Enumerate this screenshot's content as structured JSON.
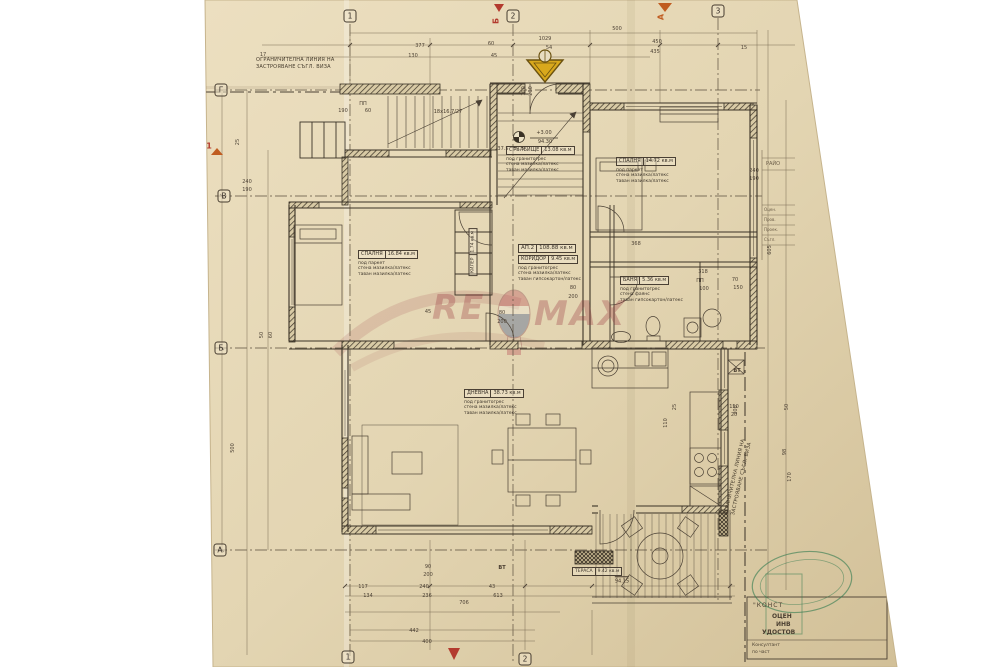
{
  "notes": {
    "boundary_top_l1": "ОГРАНИЧИТЕЛНА ЛИНИЯ НА",
    "boundary_top_l2": "ЗАСТРОЯВАНЕ СЪГЛ. ВИЗА",
    "boundary_right_l1": "ОГРАНИЧИТЕЛНА ЛИНИЯ НА",
    "boundary_right_l2": "ЗАСТРОЯВАНЕ СЪГЛ. ВИЗА",
    "stair_formula": "18x16.7/27",
    "elev_rel": "+3.00",
    "elev_abs": "94.30",
    "terrace_elev": "94.15",
    "vt1": "ВТ",
    "vt2": "ВТ"
  },
  "apartment": {
    "name": "АП.2",
    "area": "108.88 кв.м"
  },
  "rooms": [
    {
      "name": "СТЪЛБИЩЕ",
      "area": "13.08 кв.м",
      "f1": "под гранитогрес",
      "f2": "стена мазилка/латекс",
      "f3": "таван мазилка/латекс"
    },
    {
      "name": "СПАЛНЯ",
      "area": "14.72 кв.м",
      "f1": "под паркет",
      "f2": "стена мазилка/латекс",
      "f3": "таван мазилка/латекс"
    },
    {
      "name": "СПАЛНЯ",
      "area": "16.84 кв.м",
      "f1": "под паркет",
      "f2": "стена мазилка/латекс",
      "f3": "таван мазилка/латекс"
    },
    {
      "name": "КОРИДОР",
      "area": "9.45 кв.м",
      "f1": "под гранитогрес",
      "f2": "стена мазилка/латекс",
      "f3": "таван гипсокартон/латекс"
    },
    {
      "name": "БАНЯ",
      "area": "5.36 кв.м",
      "f1": "под гранитогрес",
      "f2": "стена фаянс",
      "f3": "таван гипсокартон/латекс"
    },
    {
      "name": "ДНЕВНА",
      "area": "38.73 кв.м",
      "f1": "под гранитогрес",
      "f2": "стена мазилка/латекс",
      "f3": "таван мазилка/латекс"
    },
    {
      "name": "КИЛЕР",
      "area": "1.74 кв.м"
    },
    {
      "name": "ТЕРАСА",
      "area": "9.42 кв.м"
    }
  ],
  "axis": {
    "top": [
      {
        "t": "1",
        "x": 350,
        "y": 16
      },
      {
        "t": "2",
        "x": 513,
        "y": 16
      },
      {
        "t": "3",
        "x": 718,
        "y": 11
      }
    ],
    "bottom": [
      {
        "t": "1",
        "x": 348,
        "y": 657
      },
      {
        "t": "2",
        "x": 525,
        "y": 659
      }
    ],
    "left": [
      {
        "t": "Г",
        "x": 221,
        "y": 90
      },
      {
        "t": "В",
        "x": 224,
        "y": 196
      },
      {
        "t": "Б",
        "x": 221,
        "y": 348
      },
      {
        "t": "А",
        "x": 220,
        "y": 550
      }
    ]
  },
  "red_marks": [
    {
      "t": "Б",
      "x": 496,
      "y": 21,
      "r": -90,
      "k": "red"
    },
    {
      "t": "А",
      "x": 661,
      "y": 17,
      "r": -90,
      "k": "orange"
    },
    {
      "t": "1",
      "x": 209,
      "y": 146,
      "k": "red"
    }
  ],
  "dims": [
    {
      "t": "17",
      "x": 263,
      "y": 55
    },
    {
      "t": "377",
      "x": 420,
      "y": 46
    },
    {
      "t": "130",
      "x": 413,
      "y": 56
    },
    {
      "t": "1029",
      "x": 545,
      "y": 39
    },
    {
      "t": "54",
      "x": 549,
      "y": 48
    },
    {
      "t": "500",
      "x": 617,
      "y": 29
    },
    {
      "t": "450",
      "x": 657,
      "y": 42
    },
    {
      "t": "435",
      "x": 655,
      "y": 52
    },
    {
      "t": "60",
      "x": 491,
      "y": 44
    },
    {
      "t": "45",
      "x": 494,
      "y": 56
    },
    {
      "t": "15",
      "x": 744,
      "y": 48
    },
    {
      "t": "37.5",
      "x": 503,
      "y": 149
    },
    {
      "t": "37.5",
      "x": 519,
      "y": 149
    },
    {
      "t": "25",
      "x": 238,
      "y": 142,
      "r": -90
    },
    {
      "t": "240",
      "x": 247,
      "y": 182
    },
    {
      "t": "190",
      "x": 247,
      "y": 190
    },
    {
      "t": "500",
      "x": 233,
      "y": 448,
      "r": -90
    },
    {
      "t": "50",
      "x": 262,
      "y": 335,
      "r": -90
    },
    {
      "t": "60",
      "x": 271,
      "y": 335,
      "r": -90
    },
    {
      "t": "ПП",
      "x": 363,
      "y": 104
    },
    {
      "t": "190",
      "x": 343,
      "y": 111
    },
    {
      "t": "60",
      "x": 368,
      "y": 111
    },
    {
      "t": "100",
      "x": 524,
      "y": 91,
      "r": -90
    },
    {
      "t": "200",
      "x": 531,
      "y": 91,
      "r": -90
    },
    {
      "t": "80",
      "x": 502,
      "y": 313
    },
    {
      "t": "200",
      "x": 502,
      "y": 322
    },
    {
      "t": "80",
      "x": 573,
      "y": 288
    },
    {
      "t": "200",
      "x": 573,
      "y": 297
    },
    {
      "t": "45",
      "x": 428,
      "y": 312
    },
    {
      "t": "368",
      "x": 636,
      "y": 244
    },
    {
      "t": "318",
      "x": 703,
      "y": 272
    },
    {
      "t": "ПП",
      "x": 700,
      "y": 281
    },
    {
      "t": "100",
      "x": 704,
      "y": 289
    },
    {
      "t": "70",
      "x": 735,
      "y": 280
    },
    {
      "t": "150",
      "x": 738,
      "y": 288
    },
    {
      "t": "240",
      "x": 754,
      "y": 171
    },
    {
      "t": "190",
      "x": 754,
      "y": 179
    },
    {
      "t": "605",
      "x": 770,
      "y": 250,
      "r": -90
    },
    {
      "t": "200",
      "x": 736,
      "y": 410,
      "r": -90
    },
    {
      "t": "50",
      "x": 787,
      "y": 407,
      "r": -90
    },
    {
      "t": "98",
      "x": 785,
      "y": 452,
      "r": -90
    },
    {
      "t": "170",
      "x": 790,
      "y": 477,
      "r": -90
    },
    {
      "t": "150",
      "x": 734,
      "y": 407
    },
    {
      "t": "20",
      "x": 734,
      "y": 415
    },
    {
      "t": "25",
      "x": 675,
      "y": 407,
      "r": -90
    },
    {
      "t": "110",
      "x": 666,
      "y": 423,
      "r": -90
    },
    {
      "t": "117",
      "x": 363,
      "y": 587
    },
    {
      "t": "134",
      "x": 368,
      "y": 596
    },
    {
      "t": "240",
      "x": 424,
      "y": 587
    },
    {
      "t": "236",
      "x": 427,
      "y": 596
    },
    {
      "t": "43",
      "x": 492,
      "y": 587
    },
    {
      "t": "613",
      "x": 498,
      "y": 596
    },
    {
      "t": "706",
      "x": 464,
      "y": 603
    },
    {
      "t": "442",
      "x": 414,
      "y": 631
    },
    {
      "t": "400",
      "x": 427,
      "y": 642
    },
    {
      "t": "90",
      "x": 428,
      "y": 567
    },
    {
      "t": "200",
      "x": 428,
      "y": 575
    }
  ],
  "watermark": {
    "left": "RE",
    "right": "MAX"
  },
  "title_block": {
    "region": "РАЙО",
    "rows": [
      "Оцен.",
      "Пров.",
      "Проек.",
      "Съгл."
    ]
  },
  "stamp": {
    "l1": "\"КОНСТ",
    "l2": "ОЦЕН",
    "l3": "ИНВ",
    "l4": "УДОСТОВ",
    "c1": "Консултант",
    "c2": "по част"
  },
  "colors": {
    "red": "#b33a2e",
    "orange": "#c05c20",
    "stamp_green": "#2f7a4e",
    "entrance_yellow": "#d9a81c",
    "paper": "#e4d6b4"
  }
}
